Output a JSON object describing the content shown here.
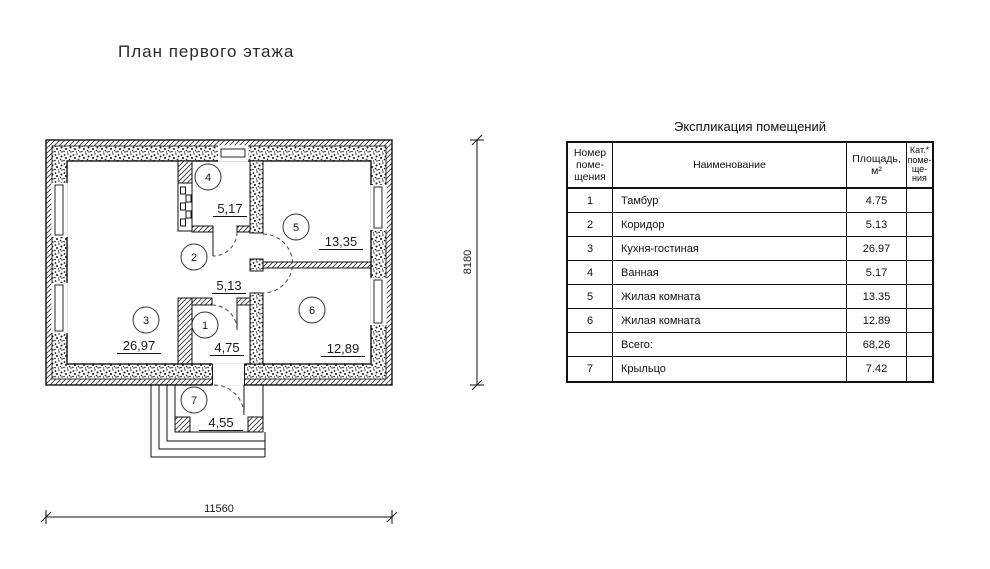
{
  "page_title": "План первого этажа",
  "plan": {
    "rooms": [
      {
        "num": "1",
        "area": "4,75"
      },
      {
        "num": "2",
        "area": "5,13"
      },
      {
        "num": "3",
        "area": "26,97"
      },
      {
        "num": "4",
        "area": "5,17"
      },
      {
        "num": "5",
        "area": "13,35"
      },
      {
        "num": "6",
        "area": "12,89"
      },
      {
        "num": "7",
        "area": "4,55"
      }
    ],
    "dim_width": "11560",
    "dim_height": "8180"
  },
  "table": {
    "title": "Экспликация помещений",
    "headers": {
      "num": "Номер\nпоме-\nщения",
      "name": "Наименование",
      "area": "Площадь,\nм²",
      "cat": "Кат.*\nпоме-\nще-\nния"
    },
    "rows": [
      {
        "num": "1",
        "name": "Тамбур",
        "area": "4.75",
        "cat": ""
      },
      {
        "num": "2",
        "name": "Коридор",
        "area": "5.13",
        "cat": ""
      },
      {
        "num": "3",
        "name": "Кухня-гостиная",
        "area": "26.97",
        "cat": ""
      },
      {
        "num": "4",
        "name": "Ванная",
        "area": "5.17",
        "cat": ""
      },
      {
        "num": "5",
        "name": "Жилая комната",
        "area": "13.35",
        "cat": ""
      },
      {
        "num": "6",
        "name": "Жилая комната",
        "area": "12.89",
        "cat": ""
      },
      {
        "num": "",
        "name": "Всего:",
        "area": "68,26",
        "cat": ""
      },
      {
        "num": "7",
        "name": "Крыльцо",
        "area": "7.42",
        "cat": ""
      }
    ]
  }
}
